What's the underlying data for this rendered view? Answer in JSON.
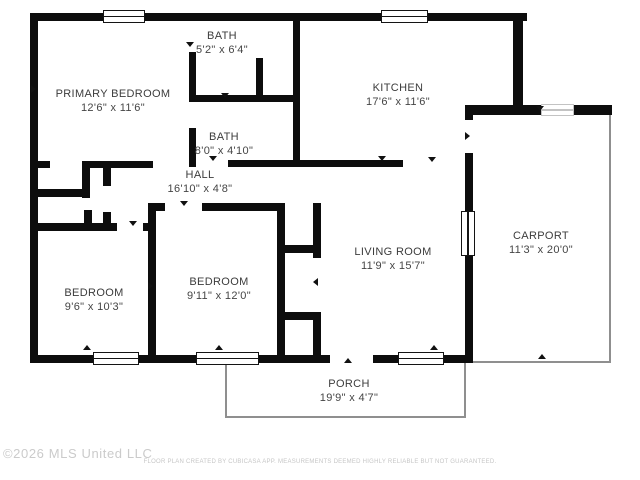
{
  "meta": {
    "width": 640,
    "height": 480,
    "title": "Floor plan"
  },
  "colors": {
    "background": "#ffffff",
    "wall": "#0d0d0d",
    "label": "#3c3c3c",
    "thin_outline": "#8f8f8f",
    "watermark": "#cbcbcb",
    "disclaimer": "#c6c6c6"
  },
  "footer": {
    "copyright": "©2026 MLS United LLC",
    "disclaimer": "FLOOR PLAN CREATED BY CUBICASA APP. MEASUREMENTS DEEMED HIGHLY RELIABLE BUT NOT GUARANTEED."
  },
  "floorplan": {
    "rooms": [
      {
        "id": "primary-bedroom",
        "name": "PRIMARY BEDROOM",
        "dims": "12'6\" x 11'6\"",
        "cx": 113,
        "cy": 101
      },
      {
        "id": "bath-upper",
        "name": "BATH",
        "dims": "5'2\" x 6'4\"",
        "cx": 222,
        "cy": 43
      },
      {
        "id": "kitchen",
        "name": "KITCHEN",
        "dims": "17'6\" x 11'6\"",
        "cx": 398,
        "cy": 95
      },
      {
        "id": "bath-lower",
        "name": "BATH",
        "dims": "8'0\" x 4'10\"",
        "cx": 224,
        "cy": 144
      },
      {
        "id": "hall",
        "name": "HALL",
        "dims": "16'10\" x 4'8\"",
        "cx": 200,
        "cy": 182
      },
      {
        "id": "living-room",
        "name": "LIVING ROOM",
        "dims": "11'9\" x 15'7\"",
        "cx": 393,
        "cy": 259
      },
      {
        "id": "carport",
        "name": "CARPORT",
        "dims": "11'3\" x 20'0\"",
        "cx": 541,
        "cy": 243
      },
      {
        "id": "bedroom-left",
        "name": "BEDROOM",
        "dims": "9'6\" x 10'3\"",
        "cx": 94,
        "cy": 300
      },
      {
        "id": "bedroom-middle",
        "name": "BEDROOM",
        "dims": "9'11\" x 12'0\"",
        "cx": 219,
        "cy": 289
      },
      {
        "id": "porch",
        "name": "PORCH",
        "dims": "19'9\" x 4'7\"",
        "cx": 349,
        "cy": 391
      }
    ],
    "walls": [
      [
        30,
        13,
        75,
        8
      ],
      [
        143,
        13,
        240,
        8
      ],
      [
        427,
        13,
        100,
        8
      ],
      [
        30,
        13,
        8,
        350
      ],
      [
        30,
        355,
        65,
        8
      ],
      [
        138,
        355,
        60,
        8
      ],
      [
        258,
        355,
        72,
        8
      ],
      [
        373,
        355,
        27,
        8
      ],
      [
        443,
        355,
        27,
        8
      ],
      [
        513,
        13,
        10,
        102
      ],
      [
        465,
        107,
        8,
        13
      ],
      [
        465,
        153,
        8,
        59
      ],
      [
        465,
        255,
        8,
        108
      ],
      [
        465,
        105,
        77,
        10
      ],
      [
        573,
        105,
        39,
        10
      ],
      [
        189,
        52,
        7,
        46
      ],
      [
        189,
        128,
        7,
        39
      ],
      [
        189,
        95,
        111,
        7
      ],
      [
        256,
        58,
        7,
        44
      ],
      [
        293,
        21,
        7,
        146
      ],
      [
        228,
        160,
        175,
        7
      ],
      [
        30,
        161,
        20,
        7
      ],
      [
        82,
        161,
        71,
        7
      ],
      [
        82,
        161,
        8,
        37
      ],
      [
        84,
        210,
        8,
        21
      ],
      [
        103,
        161,
        8,
        25
      ],
      [
        103,
        212,
        8,
        19
      ],
      [
        38,
        189,
        52,
        8
      ],
      [
        35,
        223,
        82,
        8
      ],
      [
        143,
        223,
        13,
        8
      ],
      [
        148,
        203,
        8,
        160
      ],
      [
        148,
        203,
        17,
        8
      ],
      [
        202,
        203,
        83,
        8
      ],
      [
        277,
        203,
        8,
        152
      ],
      [
        313,
        203,
        8,
        55
      ],
      [
        313,
        312,
        8,
        47
      ],
      [
        285,
        245,
        28,
        8
      ],
      [
        277,
        312,
        42,
        8
      ]
    ],
    "windows": [
      {
        "x": 103,
        "y": 10,
        "w": 42,
        "h": 13,
        "o": "h",
        "faint": false
      },
      {
        "x": 381,
        "y": 10,
        "w": 47,
        "h": 13,
        "o": "h",
        "faint": false
      },
      {
        "x": 93,
        "y": 352,
        "w": 46,
        "h": 13,
        "o": "h",
        "faint": false
      },
      {
        "x": 196,
        "y": 352,
        "w": 63,
        "h": 13,
        "o": "h",
        "faint": false
      },
      {
        "x": 398,
        "y": 352,
        "w": 46,
        "h": 13,
        "o": "h",
        "faint": false
      },
      {
        "x": 461,
        "y": 211,
        "w": 14,
        "h": 45,
        "o": "v",
        "faint": false
      },
      {
        "x": 541,
        "y": 104,
        "w": 33,
        "h": 12,
        "o": "h",
        "faint": true
      }
    ],
    "thin_lines": [
      [
        609,
        115,
        2,
        248
      ],
      [
        473,
        361,
        138,
        2
      ],
      [
        225,
        363,
        2,
        55
      ],
      [
        225,
        416,
        241,
        2
      ],
      [
        464,
        363,
        2,
        55
      ]
    ],
    "door_markers": [
      [
        190,
        47,
        "s"
      ],
      [
        35,
        90,
        "e"
      ],
      [
        225,
        98,
        "s"
      ],
      [
        213,
        161,
        "s"
      ],
      [
        382,
        161,
        "s"
      ],
      [
        432,
        162,
        "s"
      ],
      [
        469,
        137,
        "e"
      ],
      [
        540,
        111,
        "s"
      ],
      [
        133,
        226,
        "s"
      ],
      [
        184,
        206,
        "s"
      ],
      [
        152,
        287,
        "e"
      ],
      [
        317,
        283,
        "w"
      ],
      [
        348,
        363,
        "n"
      ],
      [
        542,
        359,
        "n"
      ],
      [
        219,
        350,
        "n"
      ],
      [
        434,
        350,
        "n"
      ],
      [
        87,
        350,
        "n"
      ]
    ]
  }
}
